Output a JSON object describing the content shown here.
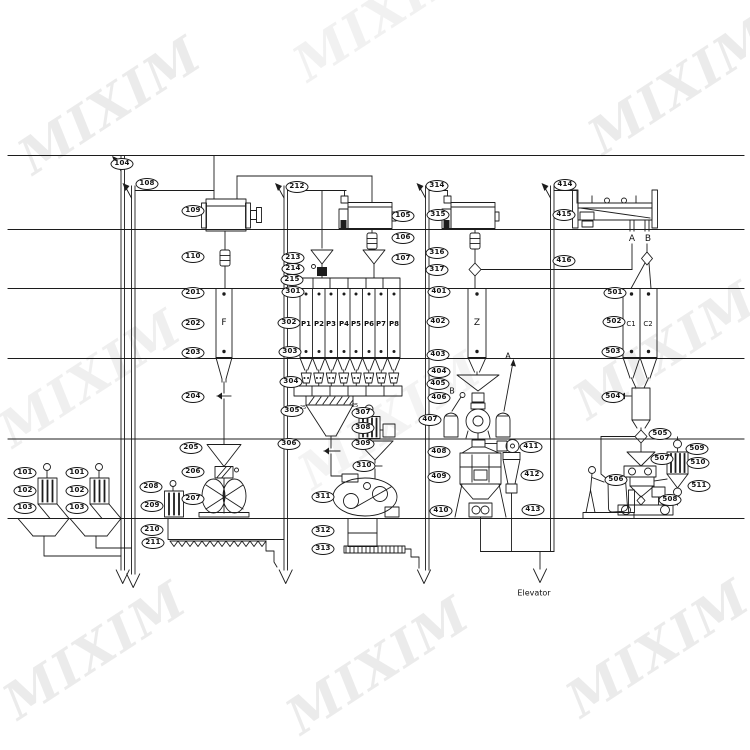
{
  "watermark": {
    "text": "MIXIM",
    "color": "#d9d9d9"
  },
  "diagram": {
    "line_color": "#1c1c1c",
    "tags": [
      {
        "t": "101",
        "x": 25,
        "y": 473
      },
      {
        "t": "102",
        "x": 25,
        "y": 491
      },
      {
        "t": "103",
        "x": 25,
        "y": 508
      },
      {
        "t": "101",
        "x": 77,
        "y": 473
      },
      {
        "t": "102",
        "x": 77,
        "y": 491
      },
      {
        "t": "103",
        "x": 77,
        "y": 508
      },
      {
        "t": "104",
        "x": 122,
        "y": 164
      },
      {
        "t": "108",
        "x": 147,
        "y": 184
      },
      {
        "t": "109",
        "x": 193,
        "y": 211
      },
      {
        "t": "110",
        "x": 193,
        "y": 257
      },
      {
        "t": "201",
        "x": 193,
        "y": 293
      },
      {
        "t": "202",
        "x": 193,
        "y": 324
      },
      {
        "t": "203",
        "x": 193,
        "y": 353
      },
      {
        "t": "204",
        "x": 193,
        "y": 397
      },
      {
        "t": "205",
        "x": 191,
        "y": 448
      },
      {
        "t": "206",
        "x": 193,
        "y": 472
      },
      {
        "t": "207",
        "x": 193,
        "y": 499
      },
      {
        "t": "208",
        "x": 151,
        "y": 487
      },
      {
        "t": "209",
        "x": 152,
        "y": 506
      },
      {
        "t": "210",
        "x": 152,
        "y": 530
      },
      {
        "t": "211",
        "x": 153,
        "y": 543
      },
      {
        "t": "212",
        "x": 297,
        "y": 187
      },
      {
        "t": "105",
        "x": 403,
        "y": 216
      },
      {
        "t": "106",
        "x": 403,
        "y": 238
      },
      {
        "t": "107",
        "x": 403,
        "y": 259
      },
      {
        "t": "213",
        "x": 293,
        "y": 258
      },
      {
        "t": "214",
        "x": 293,
        "y": 269
      },
      {
        "t": "215",
        "x": 292,
        "y": 280
      },
      {
        "t": "301",
        "x": 293,
        "y": 292
      },
      {
        "t": "302",
        "x": 289,
        "y": 323
      },
      {
        "t": "303",
        "x": 290,
        "y": 352
      },
      {
        "t": "304",
        "x": 291,
        "y": 382
      },
      {
        "t": "305",
        "x": 292,
        "y": 411
      },
      {
        "t": "306",
        "x": 289,
        "y": 444
      },
      {
        "t": "307",
        "x": 363,
        "y": 413
      },
      {
        "t": "308",
        "x": 363,
        "y": 428
      },
      {
        "t": "309",
        "x": 363,
        "y": 444
      },
      {
        "t": "310",
        "x": 364,
        "y": 466
      },
      {
        "t": "311",
        "x": 323,
        "y": 497
      },
      {
        "t": "312",
        "x": 323,
        "y": 531
      },
      {
        "t": "313",
        "x": 323,
        "y": 549
      },
      {
        "t": "314",
        "x": 437,
        "y": 186
      },
      {
        "t": "315",
        "x": 438,
        "y": 215
      },
      {
        "t": "316",
        "x": 437,
        "y": 253
      },
      {
        "t": "317",
        "x": 437,
        "y": 270
      },
      {
        "t": "401",
        "x": 439,
        "y": 292
      },
      {
        "t": "402",
        "x": 438,
        "y": 322
      },
      {
        "t": "403",
        "x": 438,
        "y": 355
      },
      {
        "t": "404",
        "x": 439,
        "y": 372
      },
      {
        "t": "405",
        "x": 438,
        "y": 384
      },
      {
        "t": "406",
        "x": 439,
        "y": 398
      },
      {
        "t": "407",
        "x": 430,
        "y": 420
      },
      {
        "t": "408",
        "x": 439,
        "y": 452
      },
      {
        "t": "409",
        "x": 439,
        "y": 477
      },
      {
        "t": "410",
        "x": 441,
        "y": 511
      },
      {
        "t": "411",
        "x": 531,
        "y": 447
      },
      {
        "t": "412",
        "x": 532,
        "y": 475
      },
      {
        "t": "413",
        "x": 533,
        "y": 510
      },
      {
        "t": "414",
        "x": 565,
        "y": 185
      },
      {
        "t": "415",
        "x": 564,
        "y": 215
      },
      {
        "t": "416",
        "x": 564,
        "y": 261
      },
      {
        "t": "501",
        "x": 615,
        "y": 293
      },
      {
        "t": "502",
        "x": 614,
        "y": 322
      },
      {
        "t": "503",
        "x": 613,
        "y": 352
      },
      {
        "t": "504",
        "x": 613,
        "y": 397
      },
      {
        "t": "505",
        "x": 660,
        "y": 434
      },
      {
        "t": "506",
        "x": 616,
        "y": 480
      },
      {
        "t": "507",
        "x": 662,
        "y": 459
      },
      {
        "t": "508",
        "x": 670,
        "y": 500
      },
      {
        "t": "509",
        "x": 697,
        "y": 449
      },
      {
        "t": "510",
        "x": 698,
        "y": 463
      },
      {
        "t": "511",
        "x": 699,
        "y": 486
      }
    ],
    "texts": [
      {
        "t": "F",
        "x": 224,
        "y": 323,
        "s": 9,
        "b": 0
      },
      {
        "t": "Z",
        "x": 477,
        "y": 323,
        "s": 9,
        "b": 0
      },
      {
        "t": "C1",
        "x": 631,
        "y": 324,
        "s": 7,
        "b": 0
      },
      {
        "t": "C2",
        "x": 648,
        "y": 324,
        "s": 7,
        "b": 0
      },
      {
        "t": "A",
        "x": 632,
        "y": 239,
        "s": 9,
        "b": 0
      },
      {
        "t": "B",
        "x": 648,
        "y": 239,
        "s": 9,
        "b": 0
      },
      {
        "t": "A",
        "x": 508,
        "y": 356,
        "s": 8,
        "b": 0
      },
      {
        "t": "B",
        "x": 452,
        "y": 391,
        "s": 8,
        "b": 0
      },
      {
        "t": "P1",
        "x": 306,
        "y": 324,
        "s": 7,
        "b": 1
      },
      {
        "t": "P2",
        "x": 319,
        "y": 324,
        "s": 7,
        "b": 1
      },
      {
        "t": "P3",
        "x": 331,
        "y": 324,
        "s": 7,
        "b": 1
      },
      {
        "t": "P4",
        "x": 344,
        "y": 324,
        "s": 7,
        "b": 1
      },
      {
        "t": "P5",
        "x": 356,
        "y": 324,
        "s": 7,
        "b": 1
      },
      {
        "t": "P6",
        "x": 369,
        "y": 324,
        "s": 7,
        "b": 1
      },
      {
        "t": "P7",
        "x": 381,
        "y": 324,
        "s": 7,
        "b": 1
      },
      {
        "t": "P8",
        "x": 394,
        "y": 324,
        "s": 7,
        "b": 1
      },
      {
        "t": "25",
        "x": 303,
        "y": 408,
        "s": 5,
        "b": 0
      },
      {
        "t": "25",
        "x": 355,
        "y": 406,
        "s": 5,
        "b": 0
      },
      {
        "t": "Elevator",
        "x": 534,
        "y": 593,
        "s": 8,
        "b": 0
      }
    ]
  }
}
